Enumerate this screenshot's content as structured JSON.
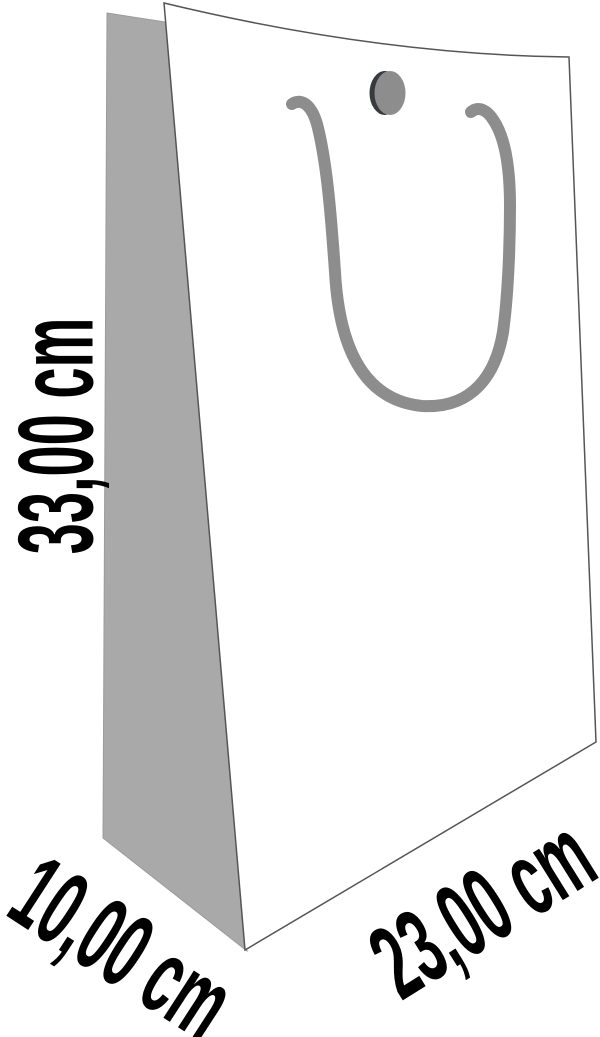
{
  "figure": {
    "type": "product-dimension-diagram",
    "subject": "paper gift bag with rope handle and grommet button"
  },
  "dimensions": {
    "height": {
      "label": "33,00 cm",
      "value": "33,00",
      "unit": "cm"
    },
    "depth": {
      "label": "10,00 cm",
      "value": "10,00",
      "unit": "cm"
    },
    "width": {
      "label": "23,00 cm",
      "value": "23,00",
      "unit": "cm"
    }
  },
  "colors": {
    "background": "#ffffff",
    "bag_front": "#ffffff",
    "bag_side_panel": "#a9a9a9",
    "rope_handle": "#8d8d8d",
    "grommet_face": "#8d8d8d",
    "grommet_rim": "#383b3e",
    "outline": "#555555",
    "label_text": "#000000"
  }
}
